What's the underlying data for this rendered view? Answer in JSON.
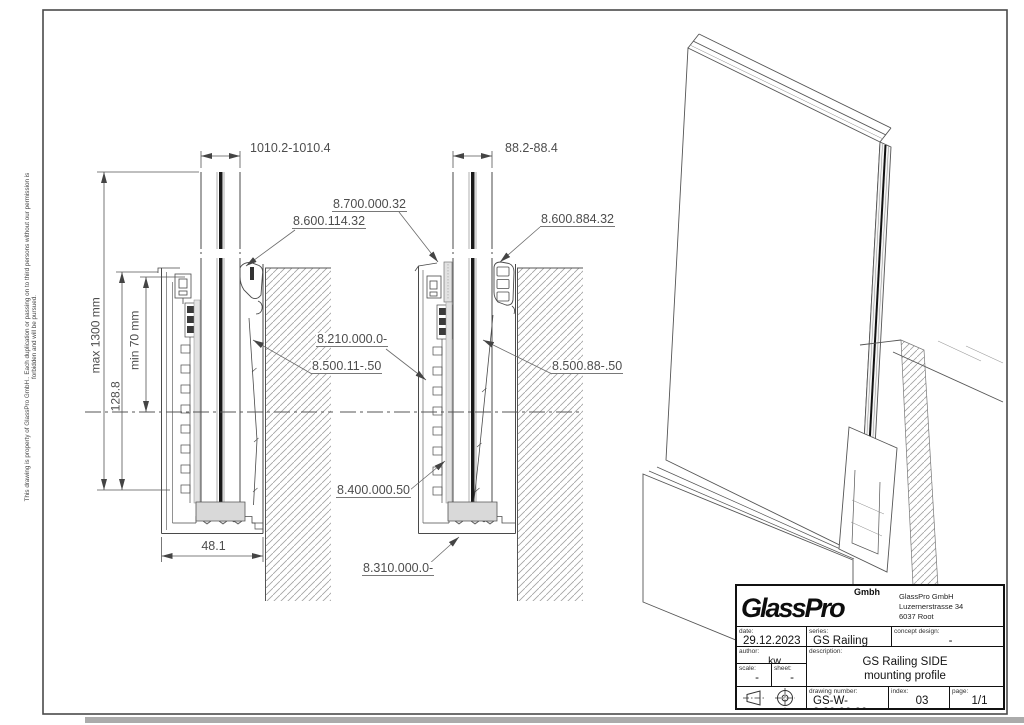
{
  "page": {
    "disclaimer": "This drawing is property of GlassPro GmbH.. Each duplication or passing on to third persons without our permission is forbidden and will be pursued."
  },
  "sections": {
    "left": {
      "top_width": "1010.2-1010.4",
      "glass_height_max": "max 1300 mm",
      "min_embed": "min 70 mm",
      "profile_depth": "128.8",
      "base_width": "48.1"
    },
    "right": {
      "top_width": "88.2-88.4"
    }
  },
  "part_labels": {
    "outer_pad": "8.700.000.32",
    "top_seal_left": "8.600.114.32",
    "top_seal_right": "8.600.884.32",
    "profile_body": "8.210.000.0-",
    "wedge_left": "8.500.11-.50",
    "wedge_right": "8.500.88-.50",
    "setting_block": "8.400.000.50",
    "base_profile": "8.310.000.0-"
  },
  "title_block": {
    "company": {
      "name": "GlassPro",
      "suffix": "Gmbh",
      "address_line1": "GlassPro GmbH",
      "address_line2": "Luzernerstrasse 34",
      "address_line3": "6037 Root"
    },
    "date": {
      "label": "date:",
      "value": "29.12.2023"
    },
    "series": {
      "label": "series:",
      "value": "GS Railing"
    },
    "concept": {
      "label": "concept design:",
      "value": "-"
    },
    "author": {
      "label": "author:",
      "value": "kw"
    },
    "scale": {
      "label": "scale:",
      "value": "-"
    },
    "sheet": {
      "label": "sheet:",
      "value": "-"
    },
    "description": {
      "label": "description:",
      "value_line1": "GS Railing SIDE",
      "value_line2": "mounting profile"
    },
    "drawing_number": {
      "label": "drawing number:",
      "value": "GS-W-8.20.00.00"
    },
    "index": {
      "label": "index:",
      "value": "03"
    },
    "page": {
      "label": "page:",
      "value": "1/1"
    }
  }
}
